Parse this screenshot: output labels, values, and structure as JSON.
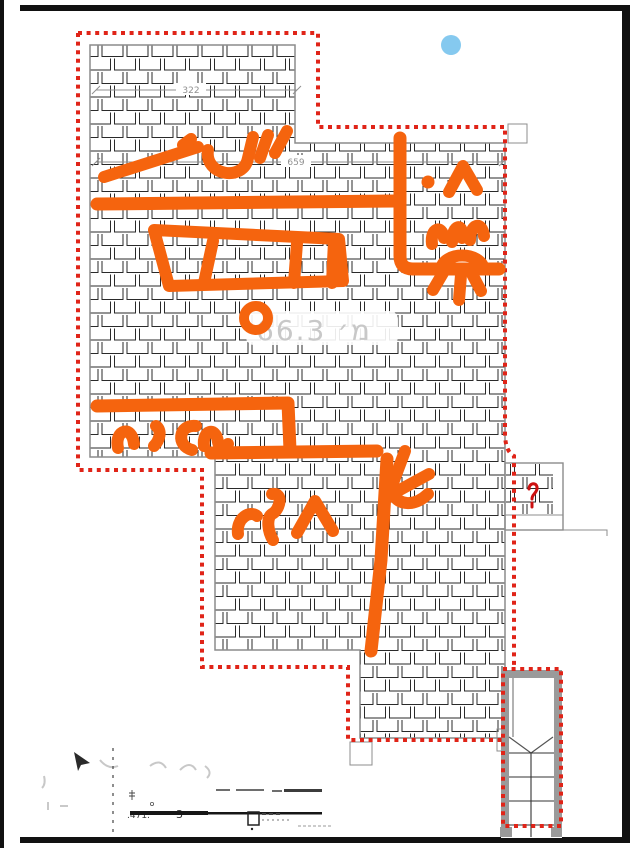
{
  "plan": {
    "dim_top": "322",
    "dim_main": "659",
    "area_text": "מ׳  66.3",
    "titleblock": {
      "fragment_scale": ".471.",
      "fragment_num": "3"
    },
    "colors": {
      "marker_orange": "#f5640e",
      "boundary_red": "#e02418",
      "dot_blue": "#85c9ef",
      "outline_gray": "#8c8c8c",
      "hatch_line": "#2a2a2a",
      "dim_gray": "#909090",
      "faint_gray": "#c8c8c8",
      "wall_gray": "#9a9a9a"
    }
  }
}
